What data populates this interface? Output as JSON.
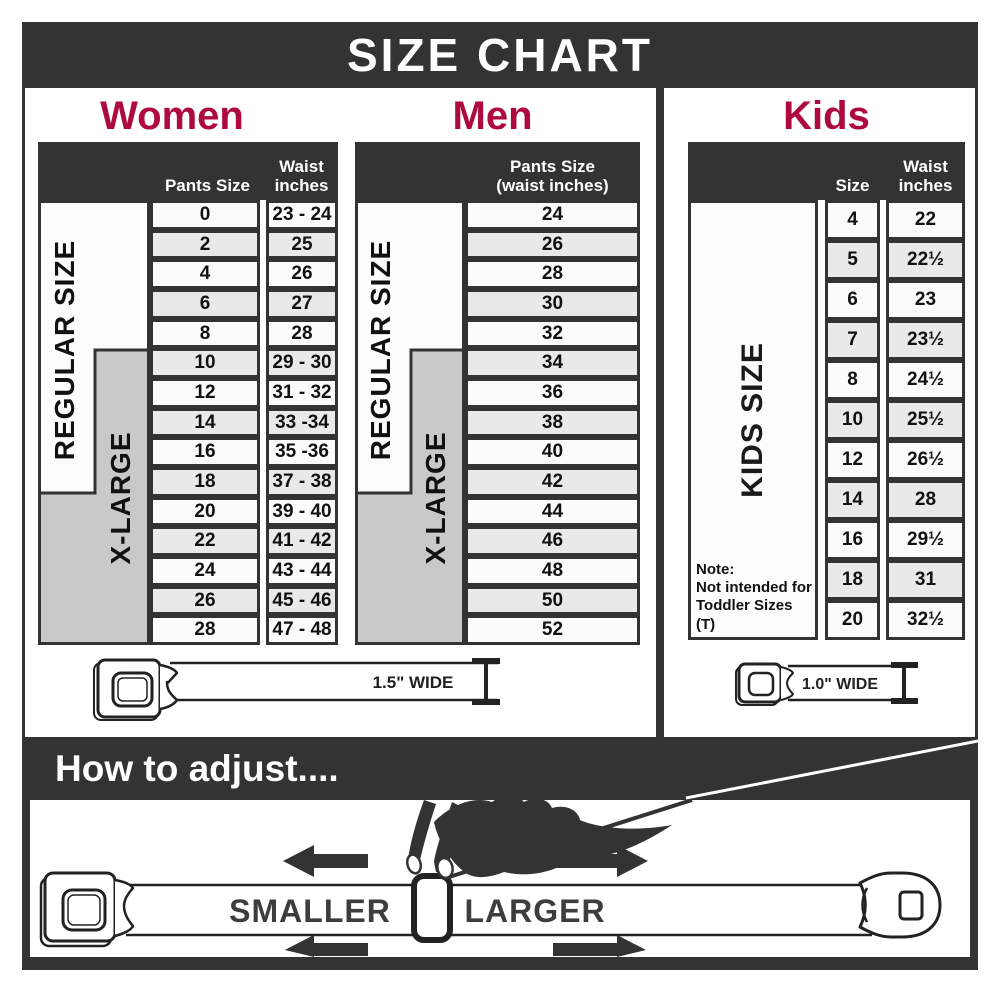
{
  "title": "SIZE CHART",
  "colors": {
    "dark": "#333333",
    "accent_red": "#ae0a3e",
    "row_light": "#fbfbfb",
    "row_alt": "#e9e9e9",
    "xlarge_gray": "#c9c9c9"
  },
  "women": {
    "heading": "Women",
    "col_pants": "Pants Size",
    "col_waist_line1": "Waist",
    "col_waist_line2": "inches",
    "regular_label": "REGULAR SIZE",
    "xlarge_label": "X-LARGE",
    "rows": [
      {
        "size": "0",
        "waist": "23 - 24"
      },
      {
        "size": "2",
        "waist": "25"
      },
      {
        "size": "4",
        "waist": "26"
      },
      {
        "size": "6",
        "waist": "27"
      },
      {
        "size": "8",
        "waist": "28"
      },
      {
        "size": "10",
        "waist": "29 - 30"
      },
      {
        "size": "12",
        "waist": "31 - 32"
      },
      {
        "size": "14",
        "waist": "33 -34"
      },
      {
        "size": "16",
        "waist": "35 -36"
      },
      {
        "size": "18",
        "waist": "37 - 38"
      },
      {
        "size": "20",
        "waist": "39 - 40"
      },
      {
        "size": "22",
        "waist": "41 - 42"
      },
      {
        "size": "24",
        "waist": "43 - 44"
      },
      {
        "size": "26",
        "waist": "45 - 46"
      },
      {
        "size": "28",
        "waist": "47 - 48"
      }
    ],
    "belt_width_label": "1.5\" WIDE"
  },
  "men": {
    "heading": "Men",
    "col_pants_line1": "Pants Size",
    "col_pants_line2": "(waist inches)",
    "regular_label": "REGULAR SIZE",
    "xlarge_label": "X-LARGE",
    "rows": [
      "24",
      "26",
      "28",
      "30",
      "32",
      "34",
      "36",
      "38",
      "40",
      "42",
      "44",
      "46",
      "48",
      "50",
      "52"
    ]
  },
  "kids": {
    "heading": "Kids",
    "col_size": "Size",
    "col_waist_line1": "Waist",
    "col_waist_line2": "inches",
    "side_label": "KIDS SIZE",
    "note_line1": "Note:",
    "note_line2": "Not intended for",
    "note_line3": "Toddler Sizes (T)",
    "rows": [
      {
        "size": "4",
        "waist": "22"
      },
      {
        "size": "5",
        "waist": "22½"
      },
      {
        "size": "6",
        "waist": "23"
      },
      {
        "size": "7",
        "waist": "23½"
      },
      {
        "size": "8",
        "waist": "24½"
      },
      {
        "size": "10",
        "waist": "25½"
      },
      {
        "size": "12",
        "waist": "26½"
      },
      {
        "size": "14",
        "waist": "28"
      },
      {
        "size": "16",
        "waist": "29½"
      },
      {
        "size": "18",
        "waist": "31"
      },
      {
        "size": "20",
        "waist": "32½"
      }
    ],
    "belt_width_label": "1.0\" WIDE"
  },
  "adjust": {
    "heading": "How to adjust....",
    "smaller_label": "SMALLER",
    "larger_label": "LARGER"
  }
}
